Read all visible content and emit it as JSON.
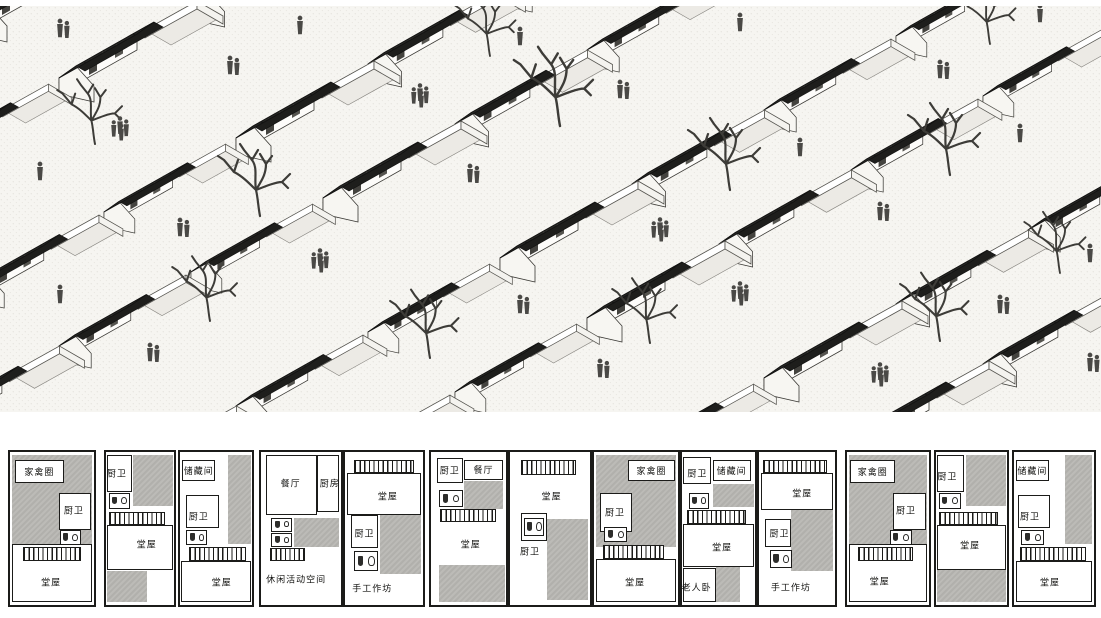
{
  "board": {
    "name": "rural-housing-presentation"
  },
  "illustration": {
    "name": "village-axonometric-view",
    "rows": 8,
    "houses_per_row": 12,
    "colors": {
      "ground": "#f6f5f1",
      "roof_dark": "#272725",
      "wall_white": "#fdfcfa",
      "figure_grey": "#4a4946",
      "tree_grey": "#3d3c38"
    }
  },
  "floor_plans": {
    "wall_color": "#1b1b19",
    "courtyard_grey": "#b6b5b1",
    "label_color": "#141412",
    "items": [
      {
        "name": "plan-1",
        "x": 8,
        "w": 88,
        "elements": [
          {
            "t": "grey",
            "x": 2,
            "y": 2,
            "w": 96,
            "h": 58
          },
          {
            "t": "box",
            "x": 6,
            "y": 5,
            "w": 58,
            "h": 15,
            "label": "家禽圈"
          },
          {
            "t": "room",
            "x": 58,
            "y": 27,
            "w": 38,
            "h": 24
          },
          {
            "t": "label",
            "x": 76,
            "y": 38,
            "label": "厨卫"
          },
          {
            "t": "wc",
            "x": 59,
            "y": 51,
            "w": 26,
            "h": 10
          },
          {
            "t": "room",
            "x": 2,
            "y": 60,
            "w": 96,
            "h": 38
          },
          {
            "t": "stairs",
            "x": 16,
            "y": 62,
            "w": 69,
            "h": 9
          },
          {
            "t": "label",
            "x": 49,
            "y": 85,
            "label": "堂屋"
          }
        ]
      },
      {
        "name": "plan-2",
        "x": 104,
        "w": 72,
        "elements": [
          {
            "t": "room",
            "x": 2,
            "y": 2,
            "w": 36,
            "h": 24
          },
          {
            "t": "label",
            "x": 16,
            "y": 14,
            "label": "厨卫"
          },
          {
            "t": "grey",
            "x": 40,
            "y": 2,
            "w": 58,
            "h": 33
          },
          {
            "t": "wc",
            "x": 4,
            "y": 27,
            "w": 31,
            "h": 10
          },
          {
            "t": "stairs",
            "x": 4,
            "y": 39,
            "w": 83,
            "h": 9
          },
          {
            "t": "room",
            "x": 2,
            "y": 48,
            "w": 96,
            "h": 29
          },
          {
            "t": "label",
            "x": 60,
            "y": 60,
            "label": "堂屋"
          },
          {
            "t": "grey",
            "x": 2,
            "y": 78,
            "w": 59,
            "h": 20
          }
        ]
      },
      {
        "name": "plan-3",
        "x": 178,
        "w": 76,
        "elements": [
          {
            "t": "grey",
            "x": 66,
            "y": 2,
            "w": 32,
            "h": 58
          },
          {
            "t": "box",
            "x": 3,
            "y": 5,
            "w": 46,
            "h": 14,
            "label": "储藏间"
          },
          {
            "t": "room",
            "x": 9,
            "y": 28,
            "w": 45,
            "h": 22
          },
          {
            "t": "label",
            "x": 26,
            "y": 42,
            "label": "厨卫"
          },
          {
            "t": "wc",
            "x": 9,
            "y": 51,
            "w": 29,
            "h": 10
          },
          {
            "t": "stairs",
            "x": 12,
            "y": 62,
            "w": 80,
            "h": 9
          },
          {
            "t": "room",
            "x": 2,
            "y": 71,
            "w": 96,
            "h": 27
          },
          {
            "t": "label",
            "x": 58,
            "y": 85,
            "label": "堂屋"
          }
        ]
      },
      {
        "name": "plan-4",
        "x": 259,
        "w": 84,
        "elements": [
          {
            "t": "room",
            "x": 6,
            "y": 2,
            "w": 64,
            "h": 39
          },
          {
            "t": "label",
            "x": 37,
            "y": 20,
            "label": "餐厅"
          },
          {
            "t": "room",
            "x": 70,
            "y": 2,
            "w": 28,
            "h": 37
          },
          {
            "t": "label",
            "x": 86,
            "y": 20,
            "label": "厨房"
          },
          {
            "t": "wc",
            "x": 13,
            "y": 43,
            "w": 26,
            "h": 9
          },
          {
            "t": "wc",
            "x": 13,
            "y": 53,
            "w": 26,
            "h": 9
          },
          {
            "t": "grey",
            "x": 41,
            "y": 43,
            "w": 57,
            "h": 19
          },
          {
            "t": "stairs",
            "x": 11,
            "y": 63,
            "w": 44,
            "h": 8
          },
          {
            "t": "label",
            "x": 44,
            "y": 83,
            "label": "休闲活动空间"
          }
        ]
      },
      {
        "name": "plan-5",
        "x": 343,
        "w": 82,
        "elements": [
          {
            "t": "stairs",
            "x": 11,
            "y": 5,
            "w": 78,
            "h": 9
          },
          {
            "t": "room",
            "x": 2,
            "y": 14,
            "w": 96,
            "h": 27
          },
          {
            "t": "label",
            "x": 55,
            "y": 29,
            "label": "堂屋"
          },
          {
            "t": "grey",
            "x": 45,
            "y": 41,
            "w": 53,
            "h": 39
          },
          {
            "t": "room",
            "x": 8,
            "y": 41,
            "w": 34,
            "h": 22
          },
          {
            "t": "label",
            "x": 25,
            "y": 53,
            "label": "厨卫"
          },
          {
            "t": "wc",
            "x": 12,
            "y": 65,
            "w": 30,
            "h": 13
          },
          {
            "t": "label",
            "x": 35,
            "y": 89,
            "label": "手工作坊"
          }
        ]
      },
      {
        "name": "plan-6",
        "x": 429,
        "w": 79,
        "elements": [
          {
            "t": "room",
            "x": 8,
            "y": 4,
            "w": 34,
            "h": 16
          },
          {
            "t": "label",
            "x": 25,
            "y": 12,
            "label": "厨卫"
          },
          {
            "t": "box",
            "x": 44,
            "y": 5,
            "w": 52,
            "h": 13,
            "label": "餐厅"
          },
          {
            "t": "grey",
            "x": 44,
            "y": 19,
            "w": 52,
            "h": 18
          },
          {
            "t": "wc",
            "x": 11,
            "y": 25,
            "w": 31,
            "h": 11
          },
          {
            "t": "stairs",
            "x": 12,
            "y": 37,
            "w": 74,
            "h": 9
          },
          {
            "t": "label",
            "x": 53,
            "y": 60,
            "label": "堂屋"
          },
          {
            "t": "grey",
            "x": 10,
            "y": 74,
            "w": 88,
            "h": 24
          }
        ]
      },
      {
        "name": "plan-7",
        "x": 508,
        "w": 84,
        "elements": [
          {
            "t": "stairs",
            "x": 14,
            "y": 5,
            "w": 68,
            "h": 10
          },
          {
            "t": "label",
            "x": 52,
            "y": 29,
            "label": "堂屋"
          },
          {
            "t": "room",
            "x": 14,
            "y": 40,
            "w": 32,
            "h": 18
          },
          {
            "t": "wc",
            "x": 17,
            "y": 43,
            "w": 26,
            "h": 12
          },
          {
            "t": "grey",
            "x": 46,
            "y": 44,
            "w": 52,
            "h": 53
          },
          {
            "t": "label",
            "x": 25,
            "y": 65,
            "label": "厨卫"
          }
        ]
      },
      {
        "name": "plan-8",
        "x": 592,
        "w": 88,
        "elements": [
          {
            "t": "grey",
            "x": 2,
            "y": 2,
            "w": 96,
            "h": 60
          },
          {
            "t": "box",
            "x": 41,
            "y": 5,
            "w": 55,
            "h": 14,
            "label": "家禽圈"
          },
          {
            "t": "room",
            "x": 7,
            "y": 27,
            "w": 38,
            "h": 25
          },
          {
            "t": "label",
            "x": 25,
            "y": 39,
            "label": "厨卫"
          },
          {
            "t": "wc",
            "x": 12,
            "y": 49,
            "w": 27,
            "h": 10
          },
          {
            "t": "room",
            "x": 2,
            "y": 70,
            "w": 96,
            "h": 28
          },
          {
            "t": "stairs",
            "x": 11,
            "y": 61,
            "w": 72,
            "h": 9
          },
          {
            "t": "label",
            "x": 49,
            "y": 85,
            "label": "堂屋"
          }
        ]
      },
      {
        "name": "plan-9",
        "x": 680,
        "w": 77,
        "elements": [
          {
            "t": "room",
            "x": 2,
            "y": 3,
            "w": 38,
            "h": 18
          },
          {
            "t": "label",
            "x": 21,
            "y": 14,
            "label": "厨卫"
          },
          {
            "t": "box",
            "x": 42,
            "y": 5,
            "w": 52,
            "h": 14,
            "label": "储藏间"
          },
          {
            "t": "grey",
            "x": 43,
            "y": 21,
            "w": 55,
            "h": 15
          },
          {
            "t": "wc",
            "x": 9,
            "y": 27,
            "w": 28,
            "h": 10
          },
          {
            "t": "stairs",
            "x": 7,
            "y": 38,
            "w": 81,
            "h": 9
          },
          {
            "t": "room",
            "x": 2,
            "y": 47,
            "w": 96,
            "h": 28
          },
          {
            "t": "label",
            "x": 55,
            "y": 62,
            "label": "堂屋"
          },
          {
            "t": "room",
            "x": 2,
            "y": 76,
            "w": 45,
            "h": 22
          },
          {
            "t": "label",
            "x": 20,
            "y": 88,
            "label": "老人卧"
          },
          {
            "t": "grey",
            "x": 47,
            "y": 75,
            "w": 33,
            "h": 23
          }
        ]
      },
      {
        "name": "plan-10",
        "x": 757,
        "w": 80,
        "elements": [
          {
            "t": "stairs",
            "x": 5,
            "y": 5,
            "w": 85,
            "h": 9
          },
          {
            "t": "room",
            "x": 2,
            "y": 14,
            "w": 96,
            "h": 24
          },
          {
            "t": "label",
            "x": 57,
            "y": 27,
            "label": "堂屋"
          },
          {
            "t": "grey",
            "x": 42,
            "y": 38,
            "w": 56,
            "h": 40
          },
          {
            "t": "room",
            "x": 8,
            "y": 44,
            "w": 34,
            "h": 18
          },
          {
            "t": "label",
            "x": 27,
            "y": 53,
            "label": "厨卫"
          },
          {
            "t": "wc",
            "x": 14,
            "y": 64,
            "w": 30,
            "h": 12
          },
          {
            "t": "label",
            "x": 42,
            "y": 88,
            "label": "手工作坊"
          }
        ]
      },
      {
        "name": "plan-11",
        "x": 845,
        "w": 86,
        "elements": [
          {
            "t": "grey",
            "x": 2,
            "y": 2,
            "w": 96,
            "h": 58
          },
          {
            "t": "box",
            "x": 4,
            "y": 5,
            "w": 55,
            "h": 15,
            "label": "家禽圈"
          },
          {
            "t": "room",
            "x": 56,
            "y": 27,
            "w": 40,
            "h": 24
          },
          {
            "t": "label",
            "x": 72,
            "y": 38,
            "label": "厨卫"
          },
          {
            "t": "wc",
            "x": 52,
            "y": 51,
            "w": 27,
            "h": 10
          },
          {
            "t": "room",
            "x": 2,
            "y": 60,
            "w": 96,
            "h": 38
          },
          {
            "t": "stairs",
            "x": 14,
            "y": 62,
            "w": 66,
            "h": 9
          },
          {
            "t": "label",
            "x": 40,
            "y": 84,
            "label": "堂屋"
          }
        ]
      },
      {
        "name": "plan-12",
        "x": 934,
        "w": 75,
        "elements": [
          {
            "t": "room",
            "x": 2,
            "y": 2,
            "w": 38,
            "h": 24
          },
          {
            "t": "label",
            "x": 16,
            "y": 16,
            "label": "厨卫"
          },
          {
            "t": "grey",
            "x": 42,
            "y": 2,
            "w": 56,
            "h": 33
          },
          {
            "t": "wc",
            "x": 4,
            "y": 27,
            "w": 31,
            "h": 10
          },
          {
            "t": "stairs",
            "x": 4,
            "y": 39,
            "w": 83,
            "h": 9
          },
          {
            "t": "room",
            "x": 2,
            "y": 48,
            "w": 96,
            "h": 29
          },
          {
            "t": "label",
            "x": 48,
            "y": 61,
            "label": "堂屋"
          },
          {
            "t": "grey",
            "x": 2,
            "y": 77,
            "w": 96,
            "h": 21
          }
        ]
      },
      {
        "name": "plan-13",
        "x": 1012,
        "w": 84,
        "elements": [
          {
            "t": "grey",
            "x": 64,
            "y": 2,
            "w": 34,
            "h": 58
          },
          {
            "t": "box",
            "x": 2,
            "y": 5,
            "w": 42,
            "h": 14,
            "label": "储藏间"
          },
          {
            "t": "room",
            "x": 5,
            "y": 28,
            "w": 40,
            "h": 22
          },
          {
            "t": "label",
            "x": 20,
            "y": 42,
            "label": "厨卫"
          },
          {
            "t": "wc",
            "x": 9,
            "y": 51,
            "w": 29,
            "h": 10
          },
          {
            "t": "stairs",
            "x": 8,
            "y": 62,
            "w": 82,
            "h": 9
          },
          {
            "t": "room",
            "x": 2,
            "y": 71,
            "w": 96,
            "h": 27
          },
          {
            "t": "label",
            "x": 45,
            "y": 85,
            "label": "堂屋"
          }
        ]
      }
    ]
  }
}
